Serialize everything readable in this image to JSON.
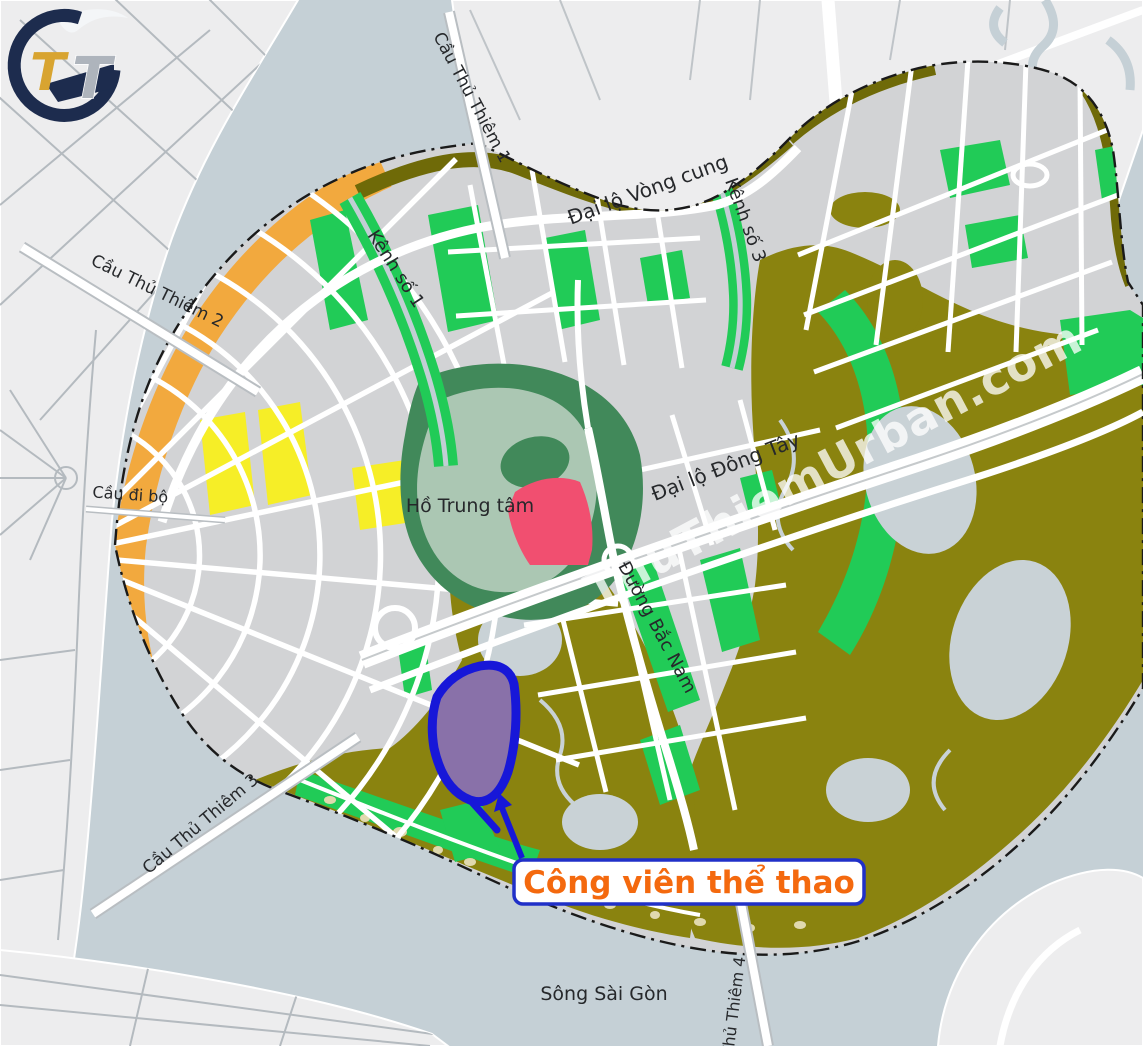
{
  "logo": {
    "letter1": "T",
    "letter2": "T"
  },
  "watermark": {
    "text": "ThuThiemUrban.com"
  },
  "map_labels": {
    "bridge1": "Cầu Thủ Thiêm 1",
    "bridge2": "Cầu Thủ Thiêm 2",
    "pedestrian_bridge": "Cầu đi bộ",
    "bridge3": "Cầu Thủ Thiêm 3",
    "bridge4": "Cầu Thủ Thiêm 4",
    "ring_boulevard": "Đại lộ Vòng cung",
    "canal1": "Kênh số 1",
    "canal3": "Kênh số 3",
    "east_west_boulevard": "Đại lộ Đông Tây",
    "north_south_road": "Đường Bắc Nam",
    "central_lake": "Hồ Trung tâm",
    "river": "Sông Sài Gòn"
  },
  "callout": {
    "label": "Công viên thể thao"
  },
  "colors": {
    "water": "#c5d0d6",
    "far_bank_land": "#ededee",
    "city_block_gray": "#d2d3d5",
    "marsh_olive": "#8a830f",
    "marsh_olive_dark": "#6f6a08",
    "park_green": "#21cb57",
    "central_park_dark_green": "#41895a",
    "central_lake_pale": "#abc7b3",
    "coastal_orange": "#f2a93e",
    "residential_yellow": "#f6ee27",
    "special_pink": "#f14f70",
    "sports_park_purple": "#8971a9",
    "highlight_blue": "#1717d8",
    "callout_border_blue": "#2030c8",
    "callout_text_orange": "#f4690e",
    "logo_navy": "#1d2c4e",
    "logo_gold": "#d8a430",
    "logo_silver": "#aeb4bc"
  }
}
